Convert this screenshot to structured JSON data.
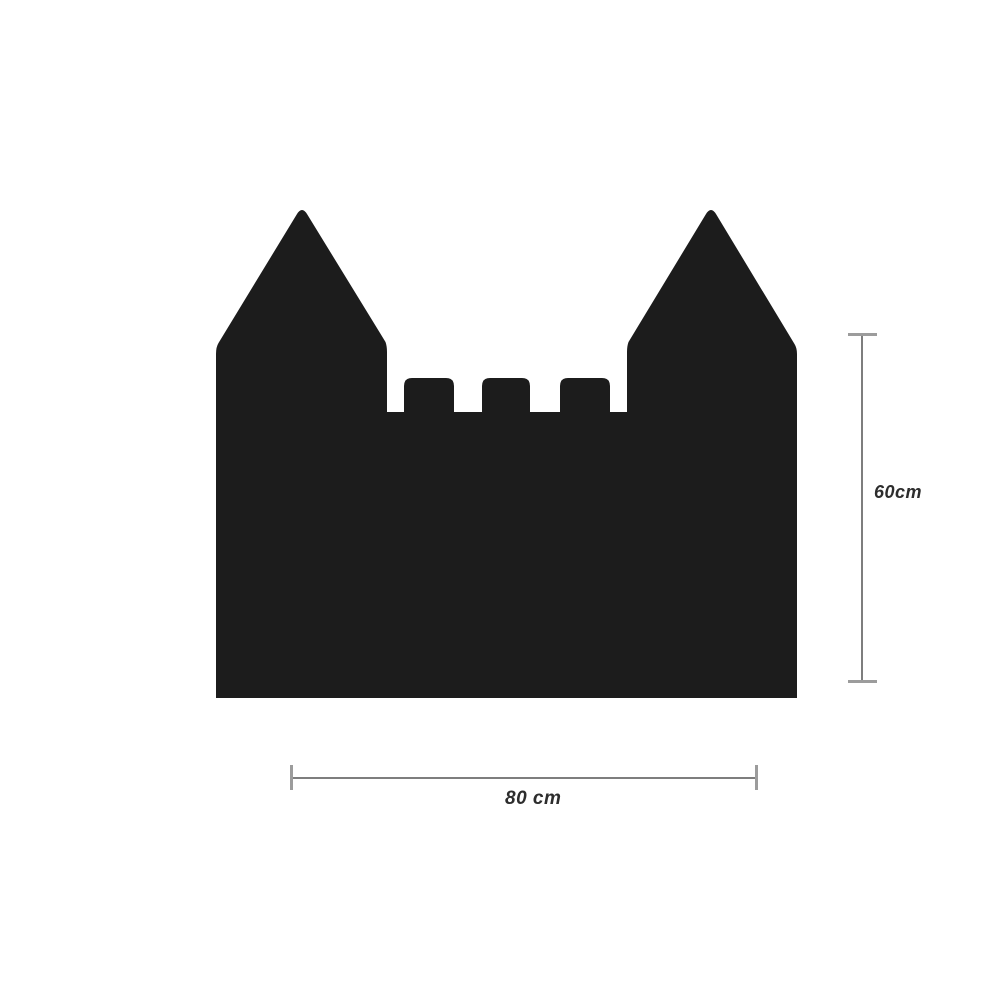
{
  "page": {
    "background": "#ffffff"
  },
  "castle": {
    "shape_name": "castle-silhouette",
    "fill": "#1c1c1c",
    "path": "M216,698 L216,354 Q216,347 218.5,343 L297,214 Q302,206 307,214 L385.5,342 Q387,346 387,352 L387,412 L404,412 L404,386 Q404,378 412,378 L446,378 Q454,378 454,386 L454,412 L482,412 L482,386 Q482,378 490,378 L522,378 Q530,378 530,386 L530,412 L560,412 L560,386 Q560,378 568,378 L602,378 Q610,378 610,386 L610,412 L627,412 L627,352 Q627,346 628.5,342 L706,214 Q711,206 716,214 L794.5,344 Q797,348 797,354 L797,698 Z"
  },
  "dimensions": {
    "height": {
      "label": "60cm"
    },
    "width": {
      "label": "80 cm"
    },
    "line_color": "#7e7e7e",
    "cap_color": "#9c9c9c",
    "label_color": "#2d2d2d"
  }
}
